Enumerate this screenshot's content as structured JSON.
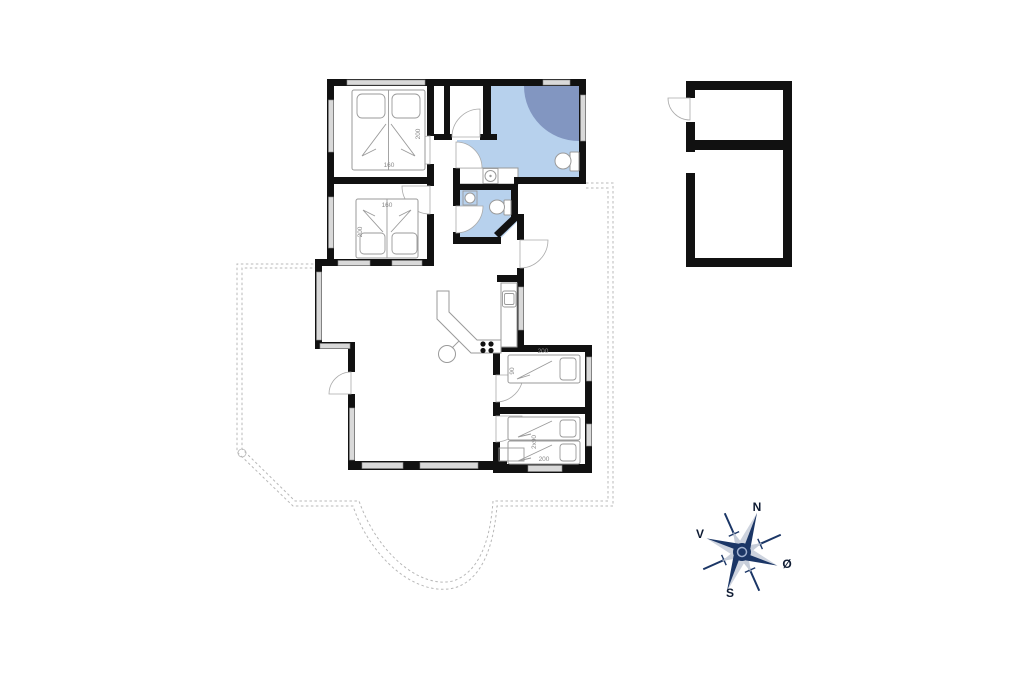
{
  "floorplan": {
    "bedroom_top": {
      "bed_length": "200",
      "bed_width": "160"
    },
    "bedroom_middle": {
      "bed_length": "200",
      "bed_width": "160"
    },
    "bedroom_small_top": {
      "bed_length": "200",
      "bed_width": "90"
    },
    "bedroom_small_bottom": {
      "bed_length": "200",
      "bed_width": "2x90"
    },
    "colors": {
      "wall": "#111111",
      "bathroom_fill": "#b7d1ed",
      "shower_fill": "#8296c1",
      "window_fill": "#d9d9d9",
      "terrace_dash": "#b8b8b8",
      "furniture_stroke": "#9a9a9a",
      "compass_navy": "#1b3666",
      "compass_light": "#c6cdd9"
    }
  },
  "compass": {
    "north_label": "N",
    "south_label": "S",
    "west_label": "V",
    "east_label": "Ø"
  }
}
